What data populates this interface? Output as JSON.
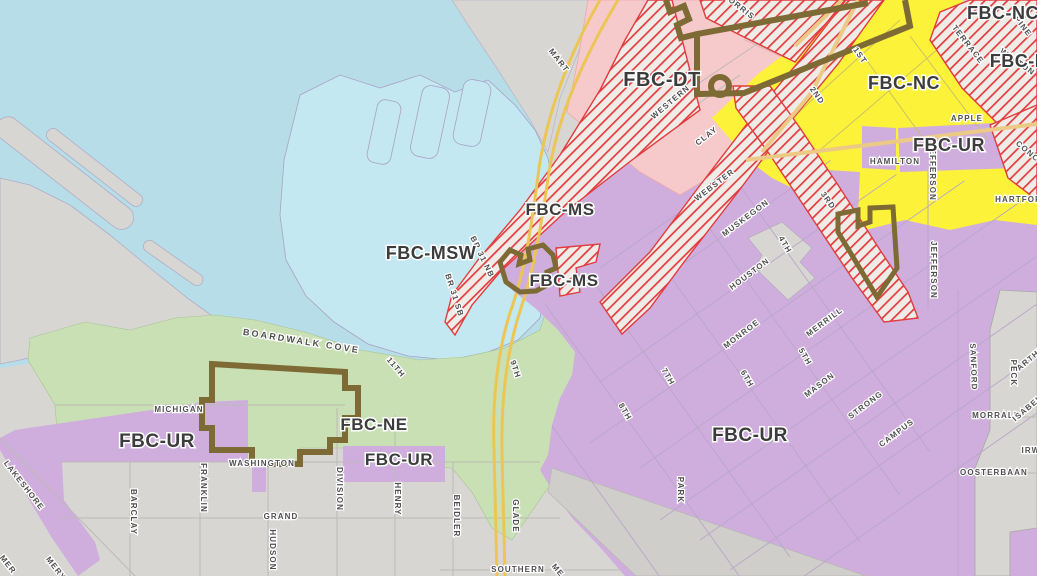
{
  "map": {
    "description": "Form-Based Code (FBC) zoning map with selected district boundaries",
    "colors": {
      "lake_water": "#b7dde8",
      "marina_water": "#c3e8f1",
      "land_gray": "#d7d6d3",
      "land_gray_dark": "#cfcecb",
      "zone_pink_dt": "#f6c9cb",
      "zone_purple_ur": "#cfaede",
      "zone_yellow_nc": "#fdf23a",
      "zone_green_ne": "#c9e0b4",
      "hatch_red": "#e23b3e",
      "hatch_bg": "#efece7",
      "boundary_brown": "#7d6a35",
      "highway_yellow": "#ecc655",
      "road_tan": "#ecca86",
      "grid_line_purple": "#b9a6c6",
      "grid_line_gray": "#bcbab5",
      "street_label_text": "#4f4f4f",
      "zone_label_text": "#3c3c3c"
    },
    "zone_labels": [
      {
        "text": "FBC-DT",
        "x": 662,
        "y": 86,
        "size": 20
      },
      {
        "text": "FBC-NC",
        "x": 904,
        "y": 89,
        "size": 18
      },
      {
        "text": "FBC-NC",
        "x": 1003,
        "y": 19,
        "size": 18
      },
      {
        "text": "FBC-M",
        "x": 1020,
        "y": 67,
        "size": 18
      },
      {
        "text": "FBC-MS",
        "x": 560,
        "y": 215,
        "size": 17
      },
      {
        "text": "FBC-MS",
        "x": 564,
        "y": 286,
        "size": 17
      },
      {
        "text": "FBC-MSW",
        "x": 431,
        "y": 259,
        "size": 18
      },
      {
        "text": "FBC-UR",
        "x": 157,
        "y": 447,
        "size": 19
      },
      {
        "text": "FBC-UR",
        "x": 399,
        "y": 465,
        "size": 17
      },
      {
        "text": "FBC-UR",
        "x": 750,
        "y": 441,
        "size": 19
      },
      {
        "text": "FBC-UR",
        "x": 949,
        "y": 151,
        "size": 18
      },
      {
        "text": "FBC-NE",
        "x": 374,
        "y": 430,
        "size": 17
      }
    ],
    "street_labels": [
      {
        "text": "MART",
        "x": 557,
        "y": 62,
        "rot": 52
      },
      {
        "text": "MORRIS",
        "x": 737,
        "y": 8,
        "rot": 38
      },
      {
        "text": "WESTERN",
        "x": 672,
        "y": 104,
        "rot": -40
      },
      {
        "text": "CLAY",
        "x": 708,
        "y": 138,
        "rot": -38
      },
      {
        "text": "1ST",
        "x": 858,
        "y": 57,
        "rot": 55
      },
      {
        "text": "2ND",
        "x": 815,
        "y": 97,
        "rot": 55
      },
      {
        "text": "3RD",
        "x": 826,
        "y": 202,
        "rot": 55
      },
      {
        "text": "4TH",
        "x": 783,
        "y": 246,
        "rot": 60
      },
      {
        "text": "WEBSTER",
        "x": 716,
        "y": 187,
        "rot": -37
      },
      {
        "text": "MUSKEGON",
        "x": 747,
        "y": 220,
        "rot": -37
      },
      {
        "text": "HOUSTON",
        "x": 751,
        "y": 276,
        "rot": -37
      },
      {
        "text": "MONROE",
        "x": 743,
        "y": 336,
        "rot": -37
      },
      {
        "text": "MERRILL",
        "x": 826,
        "y": 324,
        "rot": -37
      },
      {
        "text": "MASON",
        "x": 821,
        "y": 387,
        "rot": -37
      },
      {
        "text": "STRONG",
        "x": 867,
        "y": 407,
        "rot": -37
      },
      {
        "text": "CAMPUS",
        "x": 898,
        "y": 435,
        "rot": -37
      },
      {
        "text": "5TH",
        "x": 803,
        "y": 358,
        "rot": 60
      },
      {
        "text": "6TH",
        "x": 745,
        "y": 380,
        "rot": 60
      },
      {
        "text": "7TH",
        "x": 666,
        "y": 378,
        "rot": 60
      },
      {
        "text": "8TH",
        "x": 623,
        "y": 413,
        "rot": 60
      },
      {
        "text": "9TH",
        "x": 513,
        "y": 370,
        "rot": 72
      },
      {
        "text": "11TH",
        "x": 394,
        "y": 369,
        "rot": 50
      },
      {
        "text": "BR 31 NB",
        "x": 480,
        "y": 258,
        "rot": 64
      },
      {
        "text": "BR 31 SB",
        "x": 452,
        "y": 296,
        "rot": 72
      },
      {
        "text": "MICHIGAN",
        "x": 179,
        "y": 412,
        "rot": 0
      },
      {
        "text": "WASHINGTON",
        "x": 262,
        "y": 466,
        "rot": 0
      },
      {
        "text": "GRAND",
        "x": 281,
        "y": 519,
        "rot": 0
      },
      {
        "text": "HUDSON",
        "x": 270,
        "y": 550,
        "rot": 90
      },
      {
        "text": "FRANKLIN",
        "x": 201,
        "y": 488,
        "rot": 90
      },
      {
        "text": "BARCLAY",
        "x": 131,
        "y": 512,
        "rot": 90
      },
      {
        "text": "LAKESHORE",
        "x": 22,
        "y": 487,
        "rot": 52
      },
      {
        "text": "MER",
        "x": 6,
        "y": 566,
        "rot": 52
      },
      {
        "text": "MERY",
        "x": 54,
        "y": 570,
        "rot": 52
      },
      {
        "text": "DIVISION",
        "x": 337,
        "y": 489,
        "rot": 90
      },
      {
        "text": "HENRY",
        "x": 395,
        "y": 499,
        "rot": 90
      },
      {
        "text": "BEIDLER",
        "x": 454,
        "y": 516,
        "rot": 90
      },
      {
        "text": "GLADE",
        "x": 513,
        "y": 516,
        "rot": 90
      },
      {
        "text": "SOUTHERN",
        "x": 518,
        "y": 572,
        "rot": 0
      },
      {
        "text": "ME",
        "x": 556,
        "y": 572,
        "rot": 50
      },
      {
        "text": "PARK",
        "x": 678,
        "y": 490,
        "rot": 90
      },
      {
        "text": "SANFORD",
        "x": 971,
        "y": 367,
        "rot": 88
      },
      {
        "text": "PECK",
        "x": 1011,
        "y": 373,
        "rot": 90
      },
      {
        "text": "MORRALL",
        "x": 996,
        "y": 418,
        "rot": 0
      },
      {
        "text": "OOSTERBAAN",
        "x": 994,
        "y": 475,
        "rot": 0
      },
      {
        "text": "ARTHUR",
        "x": 1035,
        "y": 358,
        "rot": -40
      },
      {
        "text": "ISABELLA",
        "x": 1034,
        "y": 406,
        "rot": -40
      },
      {
        "text": "IRWIN",
        "x": 1036,
        "y": 453,
        "rot": 0
      },
      {
        "text": "APPLE",
        "x": 967,
        "y": 121,
        "rot": 0
      },
      {
        "text": "HAMILTON",
        "x": 895,
        "y": 164,
        "rot": 0
      },
      {
        "text": "JEFFERSON",
        "x": 930,
        "y": 172,
        "rot": 90
      },
      {
        "text": "JEFFERSON",
        "x": 931,
        "y": 270,
        "rot": 90
      },
      {
        "text": "HARTFORD",
        "x": 1022,
        "y": 202,
        "rot": 0
      },
      {
        "text": "CONCORD",
        "x": 1034,
        "y": 160,
        "rot": 40
      },
      {
        "text": "TERRACE",
        "x": 966,
        "y": 46,
        "rot": 52
      },
      {
        "text": "PINE",
        "x": 1021,
        "y": 28,
        "rot": 52
      },
      {
        "text": "WALTON",
        "x": 1016,
        "y": 64,
        "rot": 35
      }
    ],
    "place_labels": [
      {
        "text": "BOARDWALK COVE",
        "x": 301,
        "y": 344,
        "rot": 9
      }
    ],
    "highway_labels": [
      "BR 31 NB",
      "BR 31 SB"
    ]
  }
}
